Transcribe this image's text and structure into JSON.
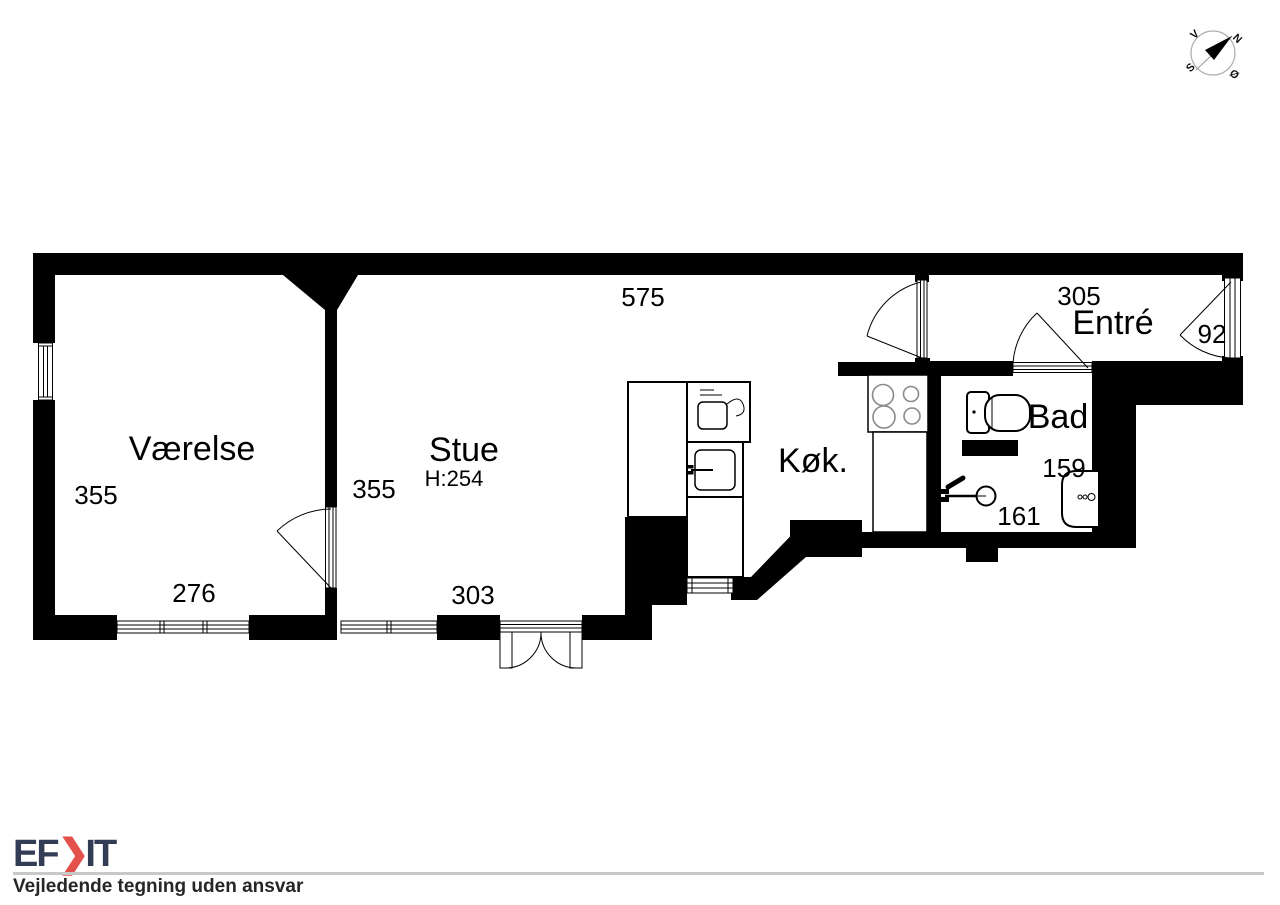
{
  "document": {
    "type_label": "floor-plan",
    "rooms": {
      "vaerelse": {
        "name": "Værelse",
        "width": "355",
        "length": "276"
      },
      "stue": {
        "name": "Stue",
        "ceiling": "H:254",
        "width": "355",
        "door": "303",
        "top": "575"
      },
      "koekken": {
        "name": "Køk."
      },
      "bad": {
        "name": "Bad",
        "dim_sink": "159",
        "dim_shower": "161"
      },
      "entre": {
        "name": "Entré",
        "length": "305",
        "width": "92"
      }
    },
    "compass": {
      "north": "N",
      "south": "S",
      "west": "V",
      "east": "Ø"
    },
    "footer": {
      "logo_ef": "EF",
      "logo_chevron": "❯",
      "logo_it": "IT",
      "disclaimer": "Vejledende tegning uden ansvar"
    },
    "colors": {
      "wall": "#000000",
      "logo_navy": "#333c55",
      "logo_red": "#e2514b",
      "divider_gray": "#c8c8c8",
      "burner_gray": "#8a8a8a",
      "compass_ring": "#b0b0b0"
    }
  }
}
